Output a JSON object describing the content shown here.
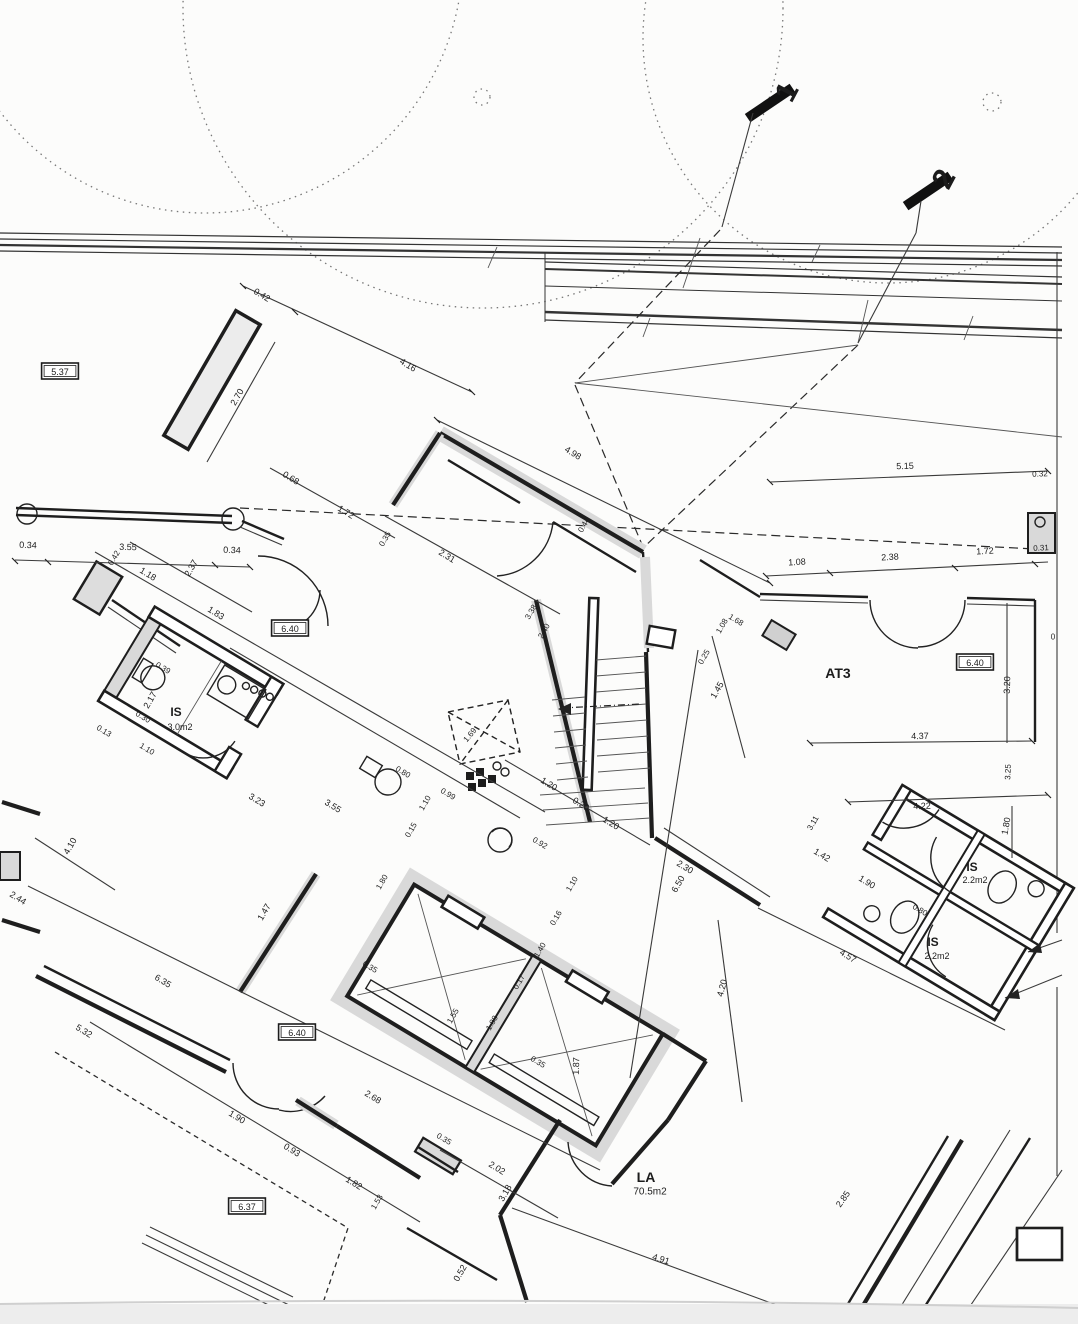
{
  "drawing": {
    "type": "architectural floor plan (scanned)",
    "ink": "#1c1c1c",
    "paper": "#fcfcfb",
    "poche_gray": "#d9d9d9"
  },
  "section_markers": [
    {
      "label": "1"
    },
    {
      "label": "2"
    }
  ],
  "level_labels": [
    "5.37",
    "6.40",
    "6.40",
    "6.40",
    "6.37"
  ],
  "rooms": [
    {
      "name": "IS",
      "area": "3.0m2"
    },
    {
      "name": "AT3",
      "area": ""
    },
    {
      "name": "IS",
      "area": "2.2m2"
    },
    {
      "name": "IS",
      "area": "2.2m2"
    },
    {
      "name": "LA",
      "area": "70.5m2"
    }
  ],
  "labels": [
    {
      "t": "1",
      "x": 787,
      "y": 92,
      "r": -62,
      "s": 30,
      "b": 1,
      "n": "section-marker-1"
    },
    {
      "t": "2",
      "x": 944,
      "y": 179,
      "r": -62,
      "s": 30,
      "b": 1,
      "n": "section-marker-2"
    },
    {
      "t": "0.42",
      "x": 262,
      "y": 295,
      "r": 31,
      "s": 9
    },
    {
      "t": "4.16",
      "x": 408,
      "y": 365,
      "r": 31,
      "s": 9
    },
    {
      "t": "4.98",
      "x": 573,
      "y": 453,
      "r": 31,
      "s": 9
    },
    {
      "t": "5.37",
      "x": 60,
      "y": 372,
      "r": 0,
      "s": 9,
      "box": 1,
      "n": "level-label"
    },
    {
      "t": "2.70",
      "x": 237,
      "y": 397,
      "r": -60,
      "s": 9
    },
    {
      "t": "0.34",
      "x": 28,
      "y": 545,
      "r": 2,
      "s": 9
    },
    {
      "t": "3.55",
      "x": 128,
      "y": 547,
      "r": 2,
      "s": 9
    },
    {
      "t": "0.34",
      "x": 232,
      "y": 550,
      "r": 2,
      "s": 9
    },
    {
      "t": "0.68",
      "x": 291,
      "y": 478,
      "r": 31,
      "s": 9
    },
    {
      "t": "1.72",
      "x": 346,
      "y": 512,
      "r": 31,
      "s": 9
    },
    {
      "t": "5.15",
      "x": 905,
      "y": 466,
      "r": -2,
      "s": 9
    },
    {
      "t": "0.32",
      "x": 1040,
      "y": 474,
      "r": -2,
      "s": 8
    },
    {
      "t": "1.08",
      "x": 797,
      "y": 562,
      "r": -3,
      "s": 9
    },
    {
      "t": "2.38",
      "x": 890,
      "y": 557,
      "r": -3,
      "s": 9
    },
    {
      "t": "1.72",
      "x": 985,
      "y": 551,
      "r": -3,
      "s": 9
    },
    {
      "t": "0.31",
      "x": 1041,
      "y": 548,
      "r": -3,
      "s": 8
    },
    {
      "t": "0.42",
      "x": 114,
      "y": 558,
      "r": -60,
      "s": 8
    },
    {
      "t": "1.18",
      "x": 148,
      "y": 574,
      "r": 31,
      "s": 9
    },
    {
      "t": "2.37",
      "x": 191,
      "y": 568,
      "r": -60,
      "s": 9
    },
    {
      "t": "1.83",
      "x": 216,
      "y": 613,
      "r": 31,
      "s": 9
    },
    {
      "t": "6.40",
      "x": 290,
      "y": 629,
      "r": 0,
      "s": 9,
      "box": 1,
      "n": "level-label"
    },
    {
      "t": "0.35",
      "x": 385,
      "y": 539,
      "r": -60,
      "s": 8
    },
    {
      "t": "2.31",
      "x": 447,
      "y": 556,
      "r": 31,
      "s": 9
    },
    {
      "t": "0.44",
      "x": 584,
      "y": 525,
      "r": -60,
      "s": 8
    },
    {
      "t": "3.38",
      "x": 531,
      "y": 612,
      "r": -60,
      "s": 8
    },
    {
      "t": "2.40",
      "x": 544,
      "y": 631,
      "r": -60,
      "s": 8
    },
    {
      "t": "1.08",
      "x": 722,
      "y": 626,
      "r": -60,
      "s": 8
    },
    {
      "t": "0.25",
      "x": 704,
      "y": 657,
      "r": -60,
      "s": 8
    },
    {
      "t": "1.45",
      "x": 717,
      "y": 690,
      "r": -60,
      "s": 9
    },
    {
      "t": "1.68",
      "x": 736,
      "y": 620,
      "r": 31,
      "s": 8
    },
    {
      "t": "2.17",
      "x": 150,
      "y": 700,
      "r": -60,
      "s": 9
    },
    {
      "t": "0.39",
      "x": 163,
      "y": 668,
      "r": 31,
      "s": 8
    },
    {
      "t": "IS",
      "x": 176,
      "y": 712,
      "r": 0,
      "s": 12,
      "b": 1,
      "n": "room-label"
    },
    {
      "t": "3.0m2",
      "x": 180,
      "y": 727,
      "r": 0,
      "s": 9,
      "n": "room-area"
    },
    {
      "t": "0.30",
      "x": 143,
      "y": 717,
      "r": 31,
      "s": 8
    },
    {
      "t": "1.10",
      "x": 147,
      "y": 749,
      "r": 31,
      "s": 8
    },
    {
      "t": "0.13",
      "x": 104,
      "y": 731,
      "r": 31,
      "s": 8
    },
    {
      "t": "3.23",
      "x": 257,
      "y": 800,
      "r": 31,
      "s": 9
    },
    {
      "t": "3.55",
      "x": 333,
      "y": 806,
      "r": 31,
      "s": 9
    },
    {
      "t": "4.10",
      "x": 70,
      "y": 846,
      "r": -60,
      "s": 9
    },
    {
      "t": "2.44",
      "x": 18,
      "y": 898,
      "r": 31,
      "s": 9
    },
    {
      "t": "1.47",
      "x": 264,
      "y": 912,
      "r": -60,
      "s": 9
    },
    {
      "t": "0.80",
      "x": 403,
      "y": 772,
      "r": 31,
      "s": 8
    },
    {
      "t": "1.10",
      "x": 425,
      "y": 803,
      "r": -60,
      "s": 8
    },
    {
      "t": "0.99",
      "x": 448,
      "y": 794,
      "r": 31,
      "s": 8
    },
    {
      "t": "0.15",
      "x": 411,
      "y": 830,
      "r": -60,
      "s": 8
    },
    {
      "t": "1.80",
      "x": 382,
      "y": 882,
      "r": -60,
      "s": 8
    },
    {
      "t": "1.69",
      "x": 470,
      "y": 735,
      "r": -50,
      "s": 8
    },
    {
      "t": "1.20",
      "x": 549,
      "y": 784,
      "r": 31,
      "s": 9
    },
    {
      "t": "0.20",
      "x": 581,
      "y": 804,
      "r": 31,
      "s": 9
    },
    {
      "t": "1.20",
      "x": 611,
      "y": 823,
      "r": 31,
      "s": 9
    },
    {
      "t": "0.92",
      "x": 540,
      "y": 843,
      "r": 31,
      "s": 8
    },
    {
      "t": "1.10",
      "x": 572,
      "y": 884,
      "r": -60,
      "s": 8
    },
    {
      "t": "0.16",
      "x": 556,
      "y": 918,
      "r": -60,
      "s": 8
    },
    {
      "t": "1.40",
      "x": 540,
      "y": 950,
      "r": -60,
      "s": 8
    },
    {
      "t": "2.30",
      "x": 685,
      "y": 867,
      "r": 31,
      "s": 9
    },
    {
      "t": "6.50",
      "x": 678,
      "y": 884,
      "r": -60,
      "s": 9
    },
    {
      "t": "4.20",
      "x": 722,
      "y": 988,
      "r": -75,
      "s": 9
    },
    {
      "t": "1.42",
      "x": 822,
      "y": 855,
      "r": 31,
      "s": 9
    },
    {
      "t": "1.90",
      "x": 867,
      "y": 882,
      "r": 31,
      "s": 9
    },
    {
      "t": "3.11",
      "x": 813,
      "y": 823,
      "r": -60,
      "s": 8
    },
    {
      "t": "AT3",
      "x": 838,
      "y": 673,
      "r": 0,
      "s": 14,
      "b": 1,
      "n": "room-label"
    },
    {
      "t": "6.40",
      "x": 975,
      "y": 663,
      "r": 0,
      "s": 9,
      "box": 1,
      "n": "level-label"
    },
    {
      "t": "3.20",
      "x": 1007,
      "y": 685,
      "r": -88,
      "s": 9
    },
    {
      "t": "4.37",
      "x": 920,
      "y": 736,
      "r": -1,
      "s": 9
    },
    {
      "t": "3.25",
      "x": 1008,
      "y": 772,
      "r": -88,
      "s": 8
    },
    {
      "t": "4.22",
      "x": 922,
      "y": 806,
      "r": -2,
      "s": 9
    },
    {
      "t": "1.80",
      "x": 1006,
      "y": 826,
      "r": -80,
      "s": 9
    },
    {
      "t": "IS",
      "x": 972,
      "y": 867,
      "r": 0,
      "s": 12,
      "b": 1,
      "n": "room-label"
    },
    {
      "t": "2.2m2",
      "x": 975,
      "y": 880,
      "r": 0,
      "s": 9,
      "n": "room-area"
    },
    {
      "t": "0.80",
      "x": 920,
      "y": 910,
      "r": 31,
      "s": 8
    },
    {
      "t": "IS",
      "x": 933,
      "y": 942,
      "r": 0,
      "s": 12,
      "b": 1,
      "n": "room-label"
    },
    {
      "t": "2.2m2",
      "x": 937,
      "y": 956,
      "r": 0,
      "s": 9,
      "n": "room-area"
    },
    {
      "t": "4.57",
      "x": 848,
      "y": 956,
      "r": 31,
      "s": 9
    },
    {
      "t": "0.35",
      "x": 370,
      "y": 967,
      "r": 31,
      "s": 8
    },
    {
      "t": "0.17",
      "x": 519,
      "y": 982,
      "r": -60,
      "s": 8
    },
    {
      "t": "1.55",
      "x": 453,
      "y": 1016,
      "r": -60,
      "s": 8
    },
    {
      "t": "1.88",
      "x": 492,
      "y": 1023,
      "r": -60,
      "s": 8
    },
    {
      "t": "0.35",
      "x": 538,
      "y": 1062,
      "r": 31,
      "s": 8
    },
    {
      "t": "2.68",
      "x": 373,
      "y": 1097,
      "r": 31,
      "s": 9
    },
    {
      "t": "0.35",
      "x": 444,
      "y": 1139,
      "r": 31,
      "s": 8
    },
    {
      "t": "1.87",
      "x": 576,
      "y": 1066,
      "r": -88,
      "s": 9
    },
    {
      "t": "6.35",
      "x": 163,
      "y": 981,
      "r": 31,
      "s": 9
    },
    {
      "t": "5.32",
      "x": 84,
      "y": 1031,
      "r": 31,
      "s": 9
    },
    {
      "t": "6.40",
      "x": 297,
      "y": 1033,
      "r": 0,
      "s": 9,
      "box": 1,
      "n": "level-label"
    },
    {
      "t": "1.90",
      "x": 237,
      "y": 1117,
      "r": 31,
      "s": 9
    },
    {
      "t": "0.93",
      "x": 292,
      "y": 1150,
      "r": 31,
      "s": 9
    },
    {
      "t": "1.82",
      "x": 354,
      "y": 1183,
      "r": 31,
      "s": 9
    },
    {
      "t": "1.53",
      "x": 377,
      "y": 1202,
      "r": -60,
      "s": 8
    },
    {
      "t": "6.37",
      "x": 247,
      "y": 1207,
      "r": 0,
      "s": 9,
      "box": 1,
      "n": "level-label"
    },
    {
      "t": "2.02",
      "x": 497,
      "y": 1168,
      "r": 31,
      "s": 9
    },
    {
      "t": "3.18",
      "x": 505,
      "y": 1193,
      "r": -60,
      "s": 9
    },
    {
      "t": "0.52",
      "x": 460,
      "y": 1273,
      "r": -60,
      "s": 9
    },
    {
      "t": "4.91",
      "x": 661,
      "y": 1259,
      "r": 17,
      "s": 9
    },
    {
      "t": "2.85",
      "x": 843,
      "y": 1199,
      "r": -55,
      "s": 9
    },
    {
      "t": "LA",
      "x": 646,
      "y": 1177,
      "r": 0,
      "s": 14,
      "b": 1,
      "n": "room-label"
    },
    {
      "t": "70.5m2",
      "x": 650,
      "y": 1192,
      "r": 0,
      "s": 10,
      "n": "room-area"
    },
    {
      "t": "0",
      "x": 1053,
      "y": 637,
      "r": 0,
      "s": 8
    }
  ]
}
